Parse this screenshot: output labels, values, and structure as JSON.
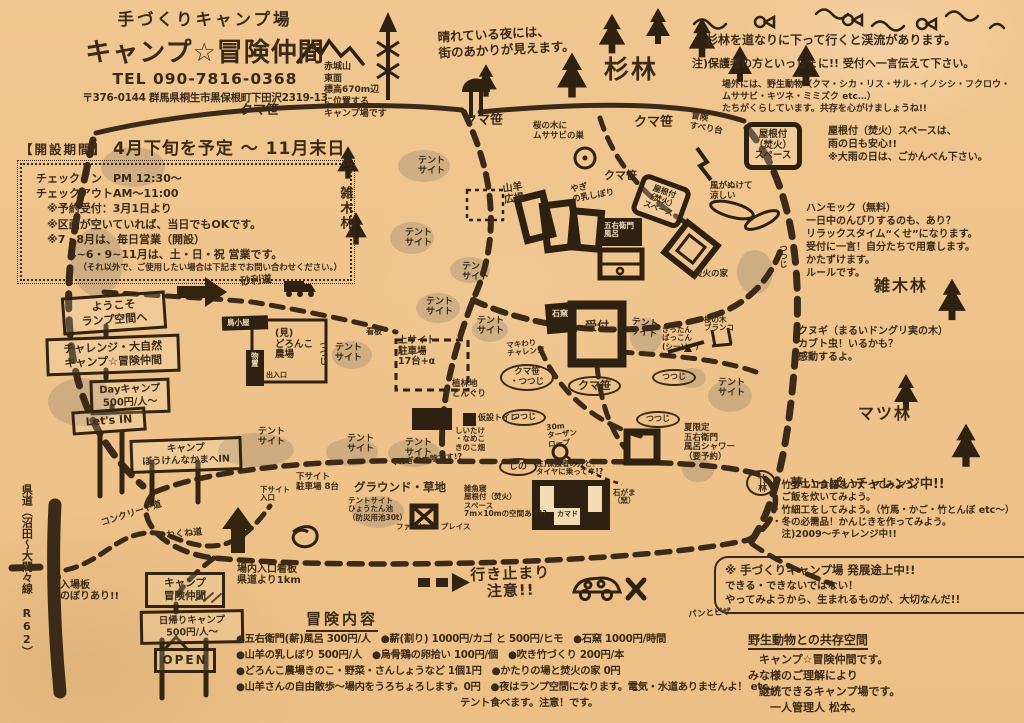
{
  "colors": {
    "paper": "#f1c791",
    "ink": "#3a2a17",
    "pencil": "#9c8a72"
  },
  "header": {
    "subtitle": "手づくりキャンプ場",
    "title": "キャンプ☆冒険仲間",
    "tel": "TEL 090-7816-0368",
    "address": "〒376-0144 群馬県桐生市黒保根町下田沢2319-13"
  },
  "mountain_note": "赤城山\n東面\n標高670m辺\nに位置する\nキャンプ場です",
  "schedule": {
    "heading": "【開設期間】",
    "period": "4月下旬を予定 ～ 11月末日",
    "lines": [
      "チェックイン　PM 12:30～",
      "チェックアウトAM～11:00",
      "　※予約受付：3月1日より",
      "　※区画が空いていれば、当日でもOKです。",
      "　※7・8月は、毎日営業（開設）",
      "　　　4~6・9~11月は、土・日・祝 営業です。",
      "（それ以外で、ご使用したい場合は下記までお問い合わせください。）"
    ]
  },
  "notes": {
    "night": "晴れている夜には、\n街のあかりが見えます。",
    "stream": "杉林を道なりに下って行くと渓流があります。",
    "guardian": "注)保護者の方といっしょに!! 受付へ一言伝えて下さい。",
    "wildlife": "場外には、野生動物（クマ・シカ・リス・サル・イノシシ・フクロウ・\nムササビ・キツネ・ミミズク etc…）\nたちがくらしています。共存を心がけましょうね!!",
    "roofed": "屋根付（焚火）スペースは、\n雨の日も安心!!\n※大雨の日は、ごかんべん下さい。",
    "hammock": "ハンモック（無料）\n一日中のんびりするのも、あり？\nリラックスタイム“くせ”になります。\n受付に一言！自分たちで用意します。\nかたずけます。\nルールです。",
    "kunugi": "クヌギ（まるいドングリ実の木）\nカブト虫！いるかも？\n感動するよ。",
    "challenge_title": "夢いっぱいチャレンジ中!!",
    "challenge_body": "・竹でエコ食器をつくってみよう。\n・ご飯を炊いてみよう。\n・竹細工をしてみよう。（竹馬・かご・竹とんぼ etc～）\n・冬の必需品！かんじきを作ってみよう。\n　注)2009～チャレンジ中!!"
  },
  "signs": {
    "welcome": "ようこそ\nランプ空間へ",
    "challenge_nature": "チャレンジ・大自然\nキャンプ☆冒険仲間",
    "day_camp": "Dayキャンプ\n500円/人～",
    "lets_in": "Let's IN",
    "bouken_in": "キャンプ\nぼうけんなかまへIN",
    "camp_name": "キャンプ\n冒険仲間",
    "day_trip": "日帰りキャンプ\n500円/人～",
    "open": "OPEN"
  },
  "menu": {
    "heading": "冒険内容",
    "lines": [
      "●五右衛門(薪)風呂 300円/人　●薪(割り) 1000円/カゴ と 500円/ヒモ　●石窯 1000円/時間",
      "●山羊の乳しぼり 500円/人　●烏骨鶏の卵拾い 100円/個　●吹き竹づくり 200円/本",
      "●どろんこ農場きのこ・野菜・さんしょうなど 1個1円　●かたりの場と焚火の家 0円",
      "●山羊さんの自由散歩～場内をうろちょろします。0円　●夜はランプ空間になります。電気・水道ありませんよ！ etc…",
      "テント食べます。注意！です。"
    ]
  },
  "dev_box": {
    "title": "※ 手づくりキャンプ場 発展途上中!!",
    "body": "できる・できないではない！\nやってみようから、生まれるものが、大切なんだ!!"
  },
  "closing": {
    "title": "野生動物との共存空間",
    "body": "　キャンプ☆冒険仲間です。\nみな様のご理解により\n　継続できるキャンプ場です。\n　　一人管理人 松本。"
  },
  "map": {
    "labels": [
      {
        "text": "クマ笹",
        "x": 240,
        "y": 104,
        "size": 13
      },
      {
        "text": "クマ笹",
        "x": 464,
        "y": 114,
        "size": 13
      },
      {
        "text": "クマ笹",
        "x": 634,
        "y": 116,
        "size": 13
      },
      {
        "text": "桜の木に\nムササビの巣",
        "x": 533,
        "y": 122,
        "size": 8.5
      },
      {
        "text": "冒険\nすべり台",
        "x": 692,
        "y": 112,
        "size": 8.5,
        "rot": 10
      },
      {
        "text": "屋根付\n（焚火）\nスペース",
        "x": 744,
        "y": 122,
        "size": 9.5,
        "cls": "roofbox"
      },
      {
        "text": "クマ笹",
        "x": 604,
        "y": 170,
        "size": 11
      },
      {
        "text": "やぎ\nの乳しぼり",
        "x": 570,
        "y": 186,
        "size": 8.5,
        "rot": -10
      },
      {
        "text": "屋根付\n（焚火）\nスペース",
        "x": 644,
        "y": 172,
        "size": 8,
        "cls": "roofbox",
        "rot": 20
      },
      {
        "text": "風がぬけて\n涼しい",
        "x": 710,
        "y": 182,
        "size": 8.5
      },
      {
        "text": "山羊\n広場",
        "x": 502,
        "y": 184,
        "size": 10,
        "rot": -8
      },
      {
        "text": "五右衛門\n風呂",
        "x": 604,
        "y": 222,
        "size": 7.5,
        "cls": "onblack"
      },
      {
        "text": "焚火の家",
        "x": 694,
        "y": 270,
        "size": 8.5
      },
      {
        "text": "受付",
        "x": 585,
        "y": 320,
        "size": 12
      },
      {
        "text": "石窯",
        "x": 552,
        "y": 310,
        "size": 8,
        "cls": "onblack"
      },
      {
        "text": "マキわり\nチャレンジ",
        "x": 506,
        "y": 342,
        "size": 7.5,
        "rot": -6
      },
      {
        "text": "ぎったん\nばっこん\n(シーソー)",
        "x": 662,
        "y": 326,
        "size": 7.5
      },
      {
        "text": "桜の木\nブランコ",
        "x": 704,
        "y": 316,
        "size": 7.5
      },
      {
        "text": "テント\nサイト",
        "x": 418,
        "y": 156,
        "size": 9
      },
      {
        "text": "テント\nサイト",
        "x": 405,
        "y": 228,
        "size": 9
      },
      {
        "text": "テント\nサイト",
        "x": 462,
        "y": 262,
        "size": 9
      },
      {
        "text": "テント\nサイト",
        "x": 426,
        "y": 297,
        "size": 9
      },
      {
        "text": "テント\nサイト",
        "x": 477,
        "y": 316,
        "size": 9
      },
      {
        "text": "テント\nサイト",
        "x": 632,
        "y": 317,
        "size": 9,
        "rot": 6
      },
      {
        "text": "テント\nサイト",
        "x": 718,
        "y": 378,
        "size": 9
      },
      {
        "text": "テント\nサイト",
        "x": 258,
        "y": 427,
        "size": 9
      },
      {
        "text": "テント\nサイト",
        "x": 347,
        "y": 434,
        "size": 9
      },
      {
        "text": "テント\nサイト",
        "x": 405,
        "y": 438,
        "size": 9
      },
      {
        "text": "テント\nサイト",
        "x": 335,
        "y": 343,
        "size": 9
      },
      {
        "text": "上サイト\n駐車場\n17台+α",
        "x": 398,
        "y": 336,
        "size": 9.5
      },
      {
        "text": "クマ笹\n・つつじ",
        "x": 500,
        "y": 364,
        "size": 8.5,
        "cls": "oval"
      },
      {
        "text": "クマ笹",
        "x": 568,
        "y": 376,
        "size": 11,
        "cls": "oval"
      },
      {
        "text": "つつじ",
        "x": 652,
        "y": 369,
        "size": 8,
        "cls": "oval"
      },
      {
        "text": "つつじ",
        "x": 502,
        "y": 409,
        "size": 8,
        "cls": "oval"
      },
      {
        "text": "つつじ",
        "x": 636,
        "y": 411,
        "size": 8,
        "cls": "oval"
      },
      {
        "text": "つつじ",
        "x": 778,
        "y": 244,
        "size": 8,
        "cls": "vertical"
      },
      {
        "text": "つつじ",
        "x": 318,
        "y": 341,
        "size": 8,
        "cls": "vertical"
      },
      {
        "text": "植林地\nどんぐり",
        "x": 452,
        "y": 380,
        "size": 8.5
      },
      {
        "text": "仮設トイレ",
        "x": 478,
        "y": 414,
        "size": 8
      },
      {
        "text": "しいたけ\n・なめこ\nきのこ畑",
        "x": 455,
        "y": 427,
        "size": 7.5
      },
      {
        "text": "しの",
        "x": 499,
        "y": 458,
        "size": 9,
        "cls": "oval"
      },
      {
        "text": "夏限定\n五右衛門\n風呂シャワー\n（要予約）",
        "x": 684,
        "y": 424,
        "size": 8.5
      },
      {
        "text": "30m\nターザン\nロープ",
        "x": 546,
        "y": 424,
        "size": 7.5,
        "rot": -6
      },
      {
        "text": "注)保護者の方と！\nタイヤに乗ってネ!?",
        "x": 536,
        "y": 460,
        "size": 7.5
      },
      {
        "text": "下サイト\n入口",
        "x": 260,
        "y": 486,
        "size": 7.5
      },
      {
        "text": "下サイト\n駐車場 8台",
        "x": 296,
        "y": 473,
        "size": 8.5
      },
      {
        "text": "グラウンド・草地",
        "x": 354,
        "y": 481,
        "size": 11.5
      },
      {
        "text": "テントサイト\nひょうたん池\n（防災用池30t）",
        "x": 348,
        "y": 497,
        "size": 7.5
      },
      {
        "text": "ファイヤー・プレイス",
        "x": 396,
        "y": 523,
        "size": 7.5
      },
      {
        "text": "雑魚寝\n屋根付（焚火）\nスペース\n7m×10mの空間あり!?",
        "x": 464,
        "y": 485,
        "size": 7.5
      },
      {
        "text": "カマド",
        "x": 557,
        "y": 511,
        "size": 7
      },
      {
        "text": "石がま\n（窯）",
        "x": 613,
        "y": 489,
        "size": 7.5
      },
      {
        "text": "竹林",
        "x": 746,
        "y": 470,
        "size": 9,
        "cls": "oval vertical"
      },
      {
        "text": "くぬぎの木陰です!?",
        "x": 390,
        "y": 459,
        "size": 8,
        "rot": -5
      },
      {
        "text": "砂利道",
        "x": 240,
        "y": 277,
        "size": 10.5,
        "rot": -5
      },
      {
        "text": "鳥小屋",
        "x": 227,
        "y": 319,
        "size": 7.5,
        "cls": "onblack"
      },
      {
        "text": "物置",
        "x": 250,
        "y": 352,
        "size": 7.5,
        "cls": "onblack vertical"
      },
      {
        "text": "(見)\nどろんこ\n農場",
        "x": 275,
        "y": 329,
        "size": 9.5
      },
      {
        "text": "出入口",
        "x": 266,
        "y": 372,
        "size": 7
      },
      {
        "text": "看板",
        "x": 366,
        "y": 328,
        "size": 8
      },
      {
        "text": "杉林",
        "x": 604,
        "y": 56,
        "size": 25,
        "cls": "forest"
      },
      {
        "text": "雑木林",
        "x": 337,
        "y": 186,
        "size": 13,
        "cls": "forest vertical"
      },
      {
        "text": "雑木林",
        "x": 874,
        "y": 277,
        "size": 16,
        "cls": "forest"
      },
      {
        "text": "マツ林",
        "x": 858,
        "y": 405,
        "size": 16,
        "cls": "forest"
      },
      {
        "text": "県道（沼田～大間々線 R62）",
        "x": 20,
        "y": 484,
        "size": 11,
        "cls": "vertical",
        "h": 205
      },
      {
        "text": "コンクリート道",
        "x": 100,
        "y": 519,
        "size": 9,
        "rot": -18
      },
      {
        "text": "くねくね道",
        "x": 157,
        "y": 532,
        "size": 9,
        "rot": -6
      },
      {
        "text": "入場板\nのぼりあり!!",
        "x": 60,
        "y": 580,
        "size": 10
      },
      {
        "text": "場内入口看板\n県道より1km",
        "x": 237,
        "y": 564,
        "size": 10
      },
      {
        "text": "行き止まり\n　注意!!",
        "x": 470,
        "y": 567,
        "size": 15,
        "cls": "big",
        "rot": -2
      },
      {
        "text": "パンとピザ",
        "x": 688,
        "y": 611,
        "size": 8.5,
        "rot": -4
      }
    ]
  }
}
